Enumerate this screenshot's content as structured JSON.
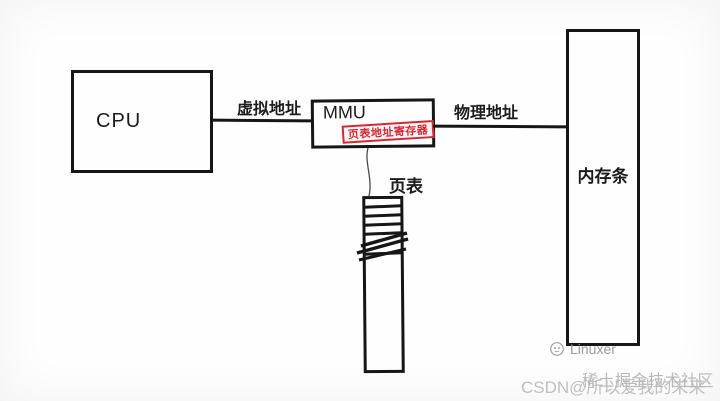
{
  "diagram": {
    "cpu": {
      "label": "CPU"
    },
    "mmu": {
      "label": "MMU",
      "register_label": "页表地址寄存器"
    },
    "memory": {
      "label": "内存条"
    },
    "page_table": {
      "label": "页表"
    },
    "virtual_address_label": "虚拟地址",
    "physical_address_label": "物理地址"
  },
  "watermarks": {
    "linuxer": "Linuxer",
    "juejin": "稀土掘金技术社区",
    "csdn": "CSDN@所以爱我的未来"
  },
  "colors": {
    "line_black": "#161616",
    "register_red": "#d22a35",
    "watermark_gray": "#9b9b9b"
  }
}
